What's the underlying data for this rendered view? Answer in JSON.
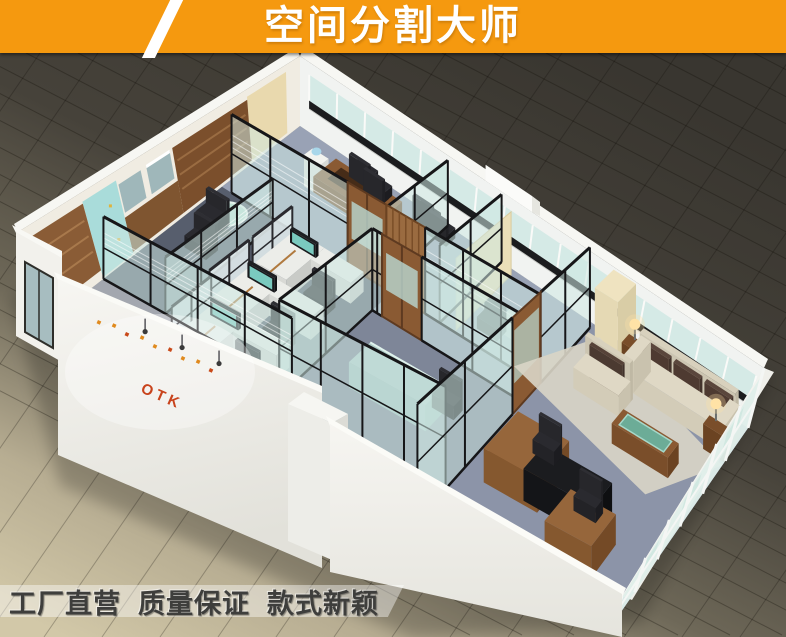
{
  "header": {
    "title": "空间分割大师"
  },
  "branding": {
    "logo": "OTK"
  },
  "footer": {
    "slogans": [
      "工厂直营",
      "质量保证",
      "款式新颖"
    ]
  },
  "palette": {
    "banner_orange": "#F5990F",
    "banner_text": "#FFFFFF",
    "slash_white": "#FFFFFF",
    "floor_dark": "#393630",
    "floor_mid": "#6E6858",
    "floor_light": "#D2C8A8",
    "wall_white": "#F4F3EF",
    "wood": "#8A5A33",
    "wood_dark": "#6B4322",
    "glass": "#CFE8E3",
    "glass_frame": "#161618",
    "mullion_white": "#FAFAF8",
    "marble_black": "#1B1C1E",
    "carpet": "#8F97AB",
    "carpet_dark": "#575E6D",
    "cream_panel": "#EBDFB8",
    "teal_panel": "#A9DCDA",
    "sofa_cream": "#DFD8C5",
    "cushion_brown": "#5A463C",
    "table_green": "#69B3A0",
    "seat_black": "#26262A",
    "screen_teal": "#7FD4C8",
    "logo_red": "#C8431C",
    "slogan_text": "#3E3E3C",
    "slogan_band": "rgba(255,255,255,0.42)"
  }
}
